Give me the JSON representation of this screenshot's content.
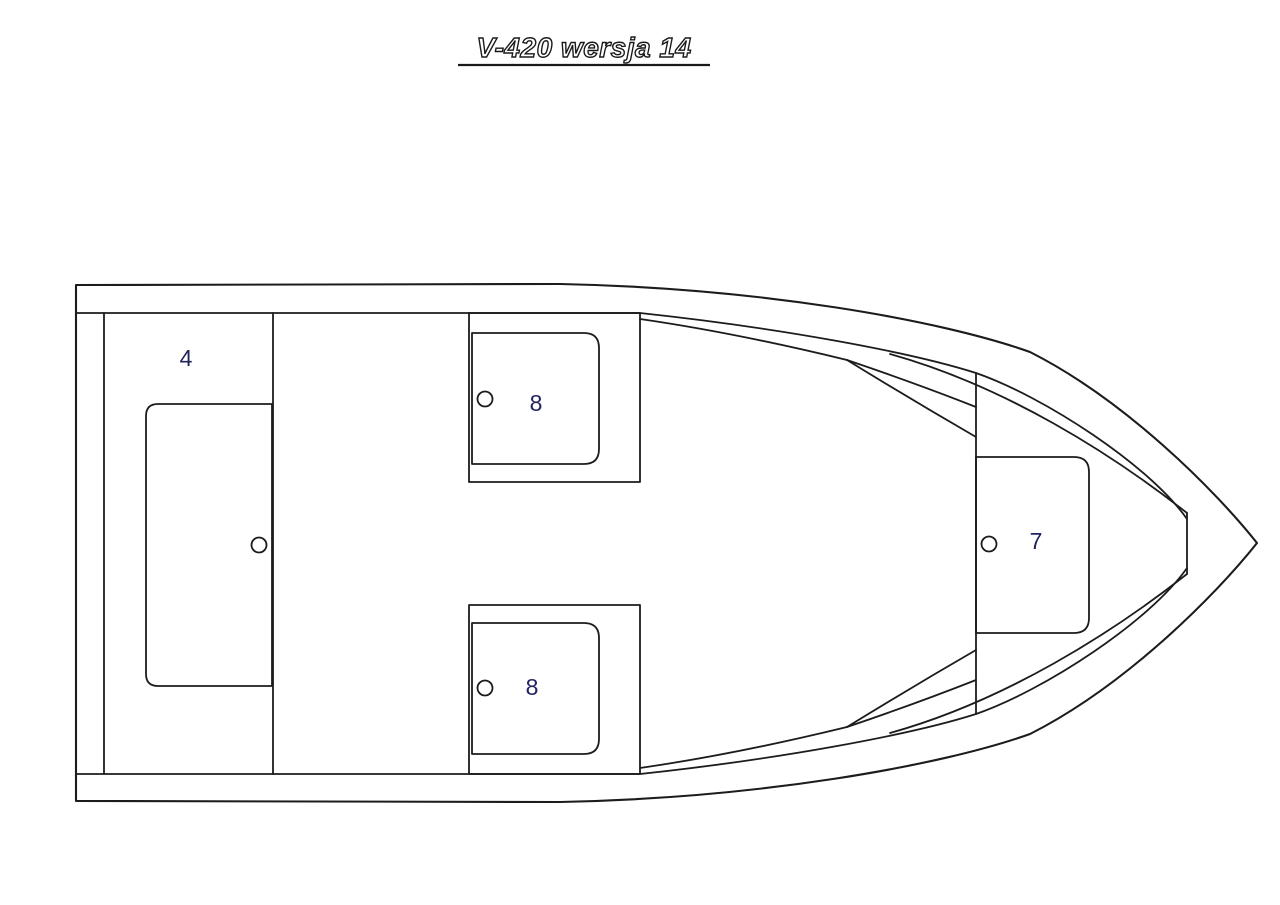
{
  "title": {
    "text": "V-420 wersja 14",
    "underlined": true
  },
  "drawing": {
    "type": "boat-floorplan-top-view",
    "labels": {
      "stern_bench": "4",
      "seat_upper": "8",
      "seat_lower": "8",
      "bow_seat": "7"
    },
    "colors": {
      "line": "#1c1c1c",
      "label": "#232360",
      "background": "#ffffff",
      "title_fill": "#ffffff",
      "title_outline": "#1a1a1a"
    }
  }
}
